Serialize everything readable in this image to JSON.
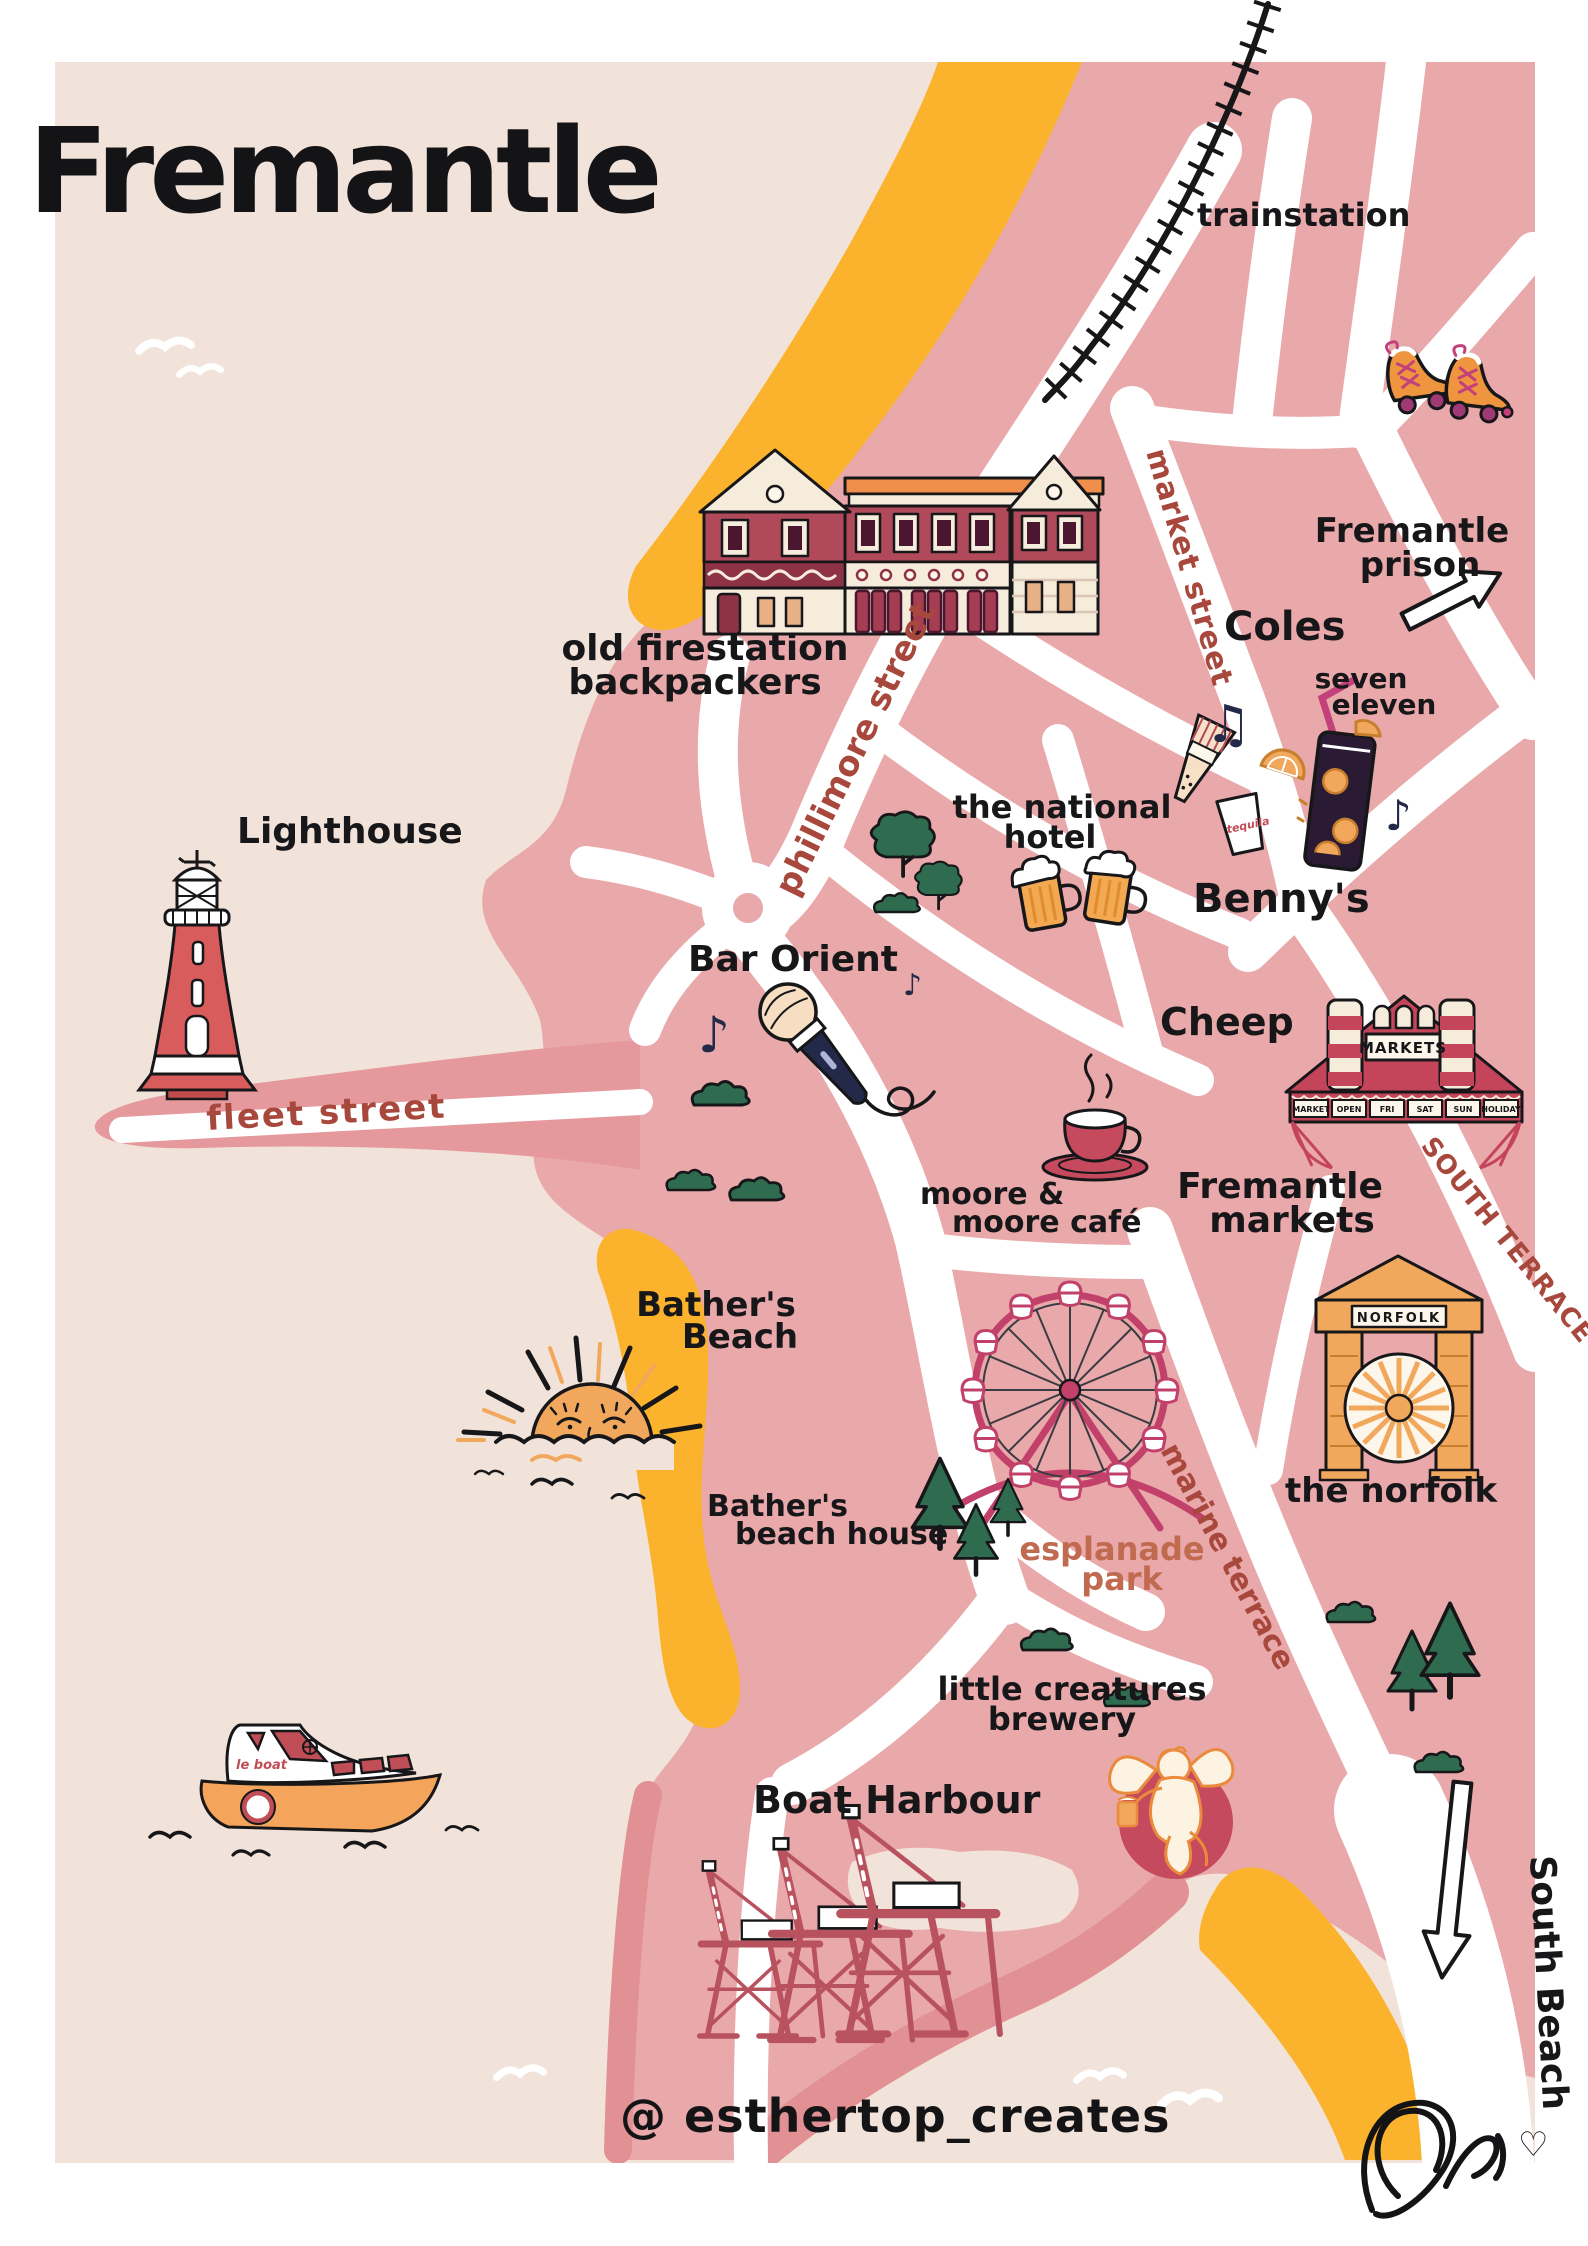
{
  "title": "Fremantle",
  "credit": "@ esthertop_creates",
  "streets": {
    "market": "market street",
    "phillimore": "phillimore street",
    "fleet": "fleet street",
    "south_terrace": "SOUTH TERRACE",
    "marine_terrace": "marine terrace"
  },
  "places": {
    "trainstation": "trainstation",
    "prison_l1": "Fremantle",
    "prison_l2": "prison",
    "coles": "Coles",
    "seven_l1": "seven",
    "seven_l2": "eleven",
    "bennys": "Benny's",
    "national_l1": "the national",
    "national_l2": "hotel",
    "firestation_l1": "old firestation",
    "firestation_l2": "backpackers",
    "lighthouse": "Lighthouse",
    "bar_orient": "Bar Orient",
    "cheep": "Cheep",
    "markets_l1": "Fremantle",
    "markets_l2": "markets",
    "moore_l1": "moore &",
    "moore_l2": "moore café",
    "bathers_l1": "Bather's",
    "bathers_l2": "Beach",
    "beach_house_l1": "Bather's",
    "beach_house_l2": "beach house",
    "esplanade_l1": "esplanade",
    "esplanade_l2": "park",
    "norfolk": "the norfolk",
    "creatures_l1": "little creatures",
    "creatures_l2": "brewery",
    "boat_harbour": "Boat Harbour",
    "south_beach": "South Beach"
  },
  "signs": {
    "markets_roof": "MARKETS",
    "market_days": [
      "MARKET",
      "OPEN",
      "FRI",
      "SAT",
      "SUN",
      "HOLIDAY"
    ],
    "norfolk_arch": "NORFOLK",
    "boat_name": "le boat",
    "tequila_cup": "tequila"
  },
  "icons": {
    "music_note": "♪",
    "music_notes": "♫",
    "heart": "♡"
  },
  "colors": {
    "cream": "#f2e3da",
    "pink_land": "#e9a8aa",
    "salmon_accent": "#e19093",
    "beach_yellow": "#fbb32d",
    "street_maroon": "#a8483d",
    "esplanade_terracotta": "#c06a50",
    "road_white": "#ffffff",
    "tree_green": "#2e6b4f",
    "navy_ink": "#232949",
    "lighthouse_red": "#d95c5c",
    "building_maroon": "#b04a5a",
    "markets_crimson": "#c44459",
    "wheel_magenta": "#c2416b",
    "arch_orange": "#f2a85c",
    "boat_orange": "#f5a55b",
    "crane_red": "#b9525f",
    "logo_circle": "#c64a5e"
  }
}
